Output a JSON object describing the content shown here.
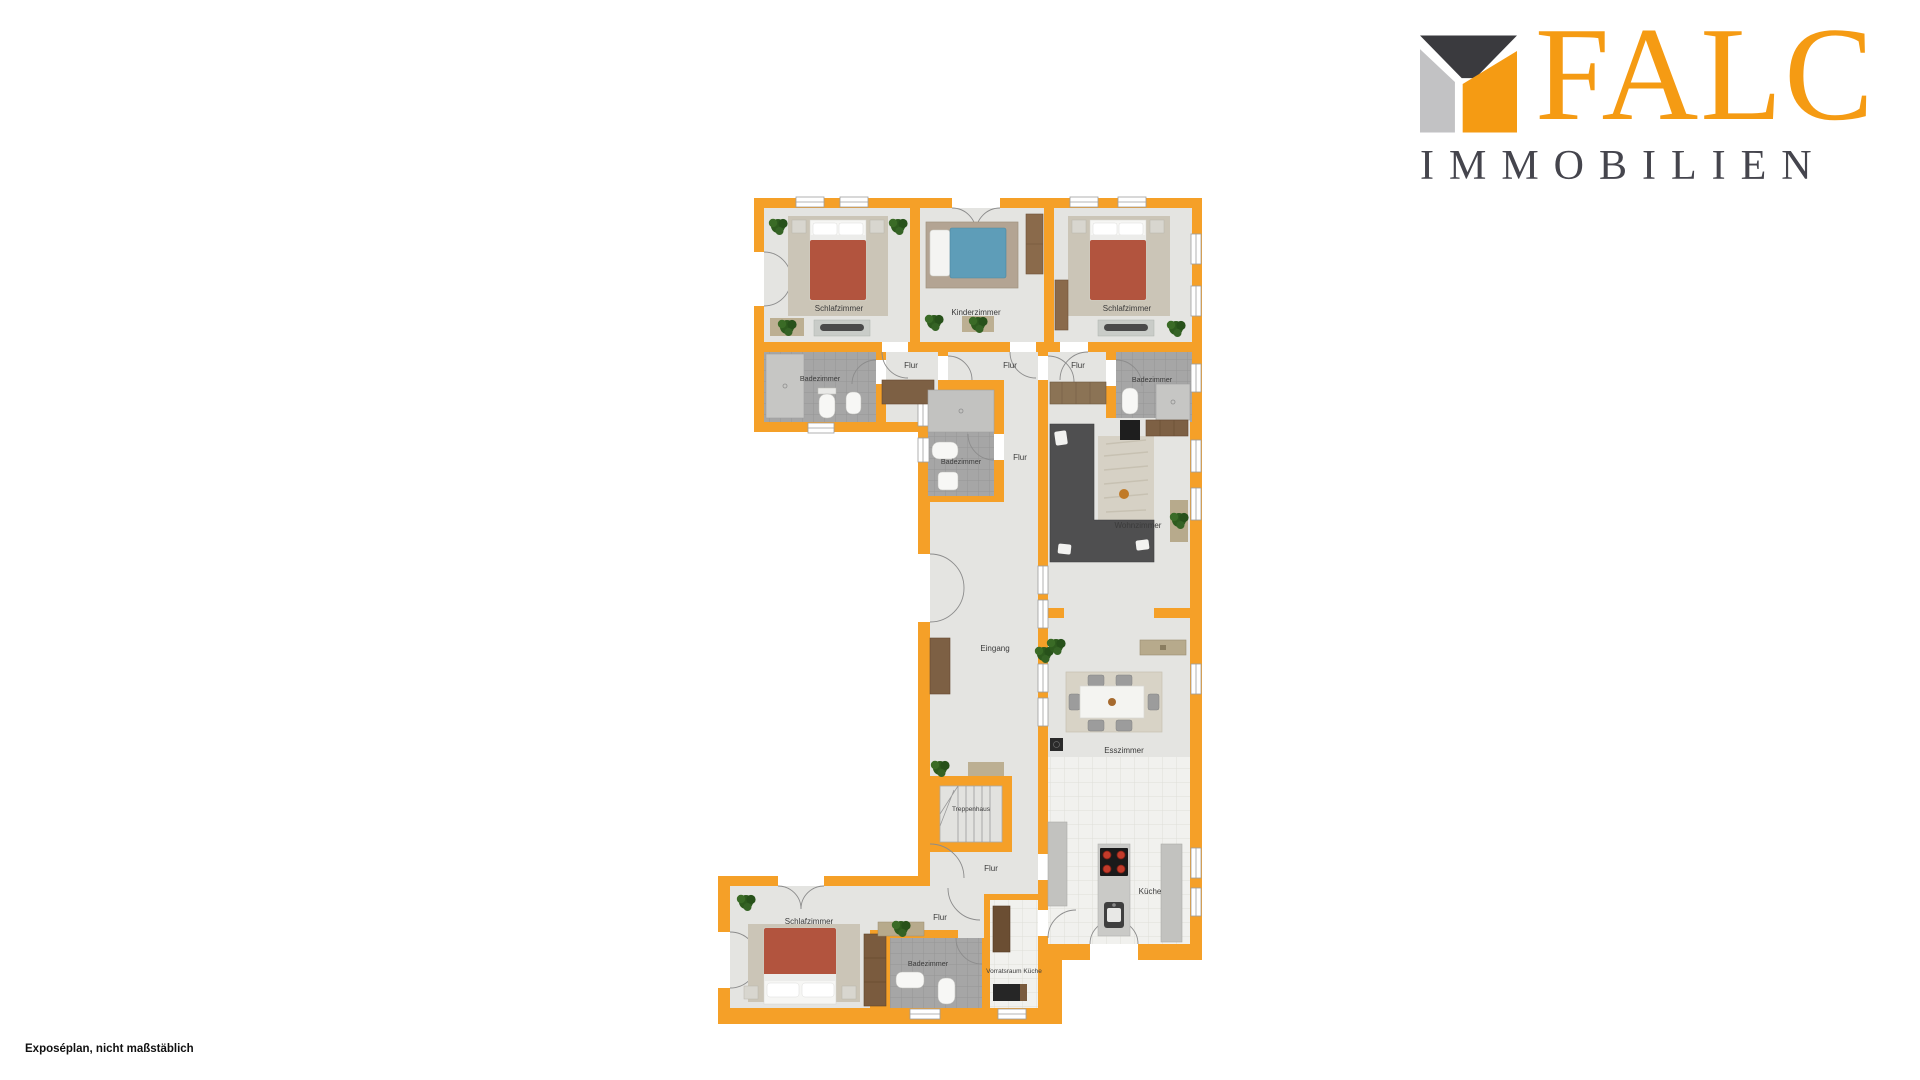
{
  "logo": {
    "brand": "FALC",
    "subtitle": "IMMOBILIEN"
  },
  "footer": {
    "note": "Exposéplan, nicht maßstäblich"
  },
  "palette": {
    "wall_orange": "#F5A028",
    "floor_gray": "#E4E4E1",
    "logo_orange": "#F59B13",
    "logo_dark": "#45454D",
    "logo_gray": "#C2C2C4",
    "bed_red": "#B2543E",
    "kids_bed_blue": "#5E9DB8"
  },
  "floorplan": {
    "rooms": [
      {
        "id": "bedroom-top-left",
        "label": "Schlafzimmer"
      },
      {
        "id": "kids-room",
        "label": "Kinderzimmer"
      },
      {
        "id": "bedroom-top-right",
        "label": "Schlafzimmer"
      },
      {
        "id": "bathroom-top-left",
        "label": "Badezimmer"
      },
      {
        "id": "hall-top-left",
        "label": "Flur"
      },
      {
        "id": "hall-top-center",
        "label": "Flur"
      },
      {
        "id": "hall-top-right",
        "label": "Flur"
      },
      {
        "id": "bathroom-top-right",
        "label": "Badezimmer"
      },
      {
        "id": "bathroom-middle",
        "label": "Badezimmer"
      },
      {
        "id": "hall-middle",
        "label": "Flur"
      },
      {
        "id": "living-room",
        "label": "Wohnzimmer"
      },
      {
        "id": "entrance",
        "label": "Eingang"
      },
      {
        "id": "dining-room",
        "label": "Esszimmer"
      },
      {
        "id": "staircase",
        "label": "Treppenhaus"
      },
      {
        "id": "hall-lower",
        "label": "Flur"
      },
      {
        "id": "kitchen",
        "label": "Küche"
      },
      {
        "id": "bedroom-bottom",
        "label": "Schlafzimmer"
      },
      {
        "id": "hall-bottom",
        "label": "Flur"
      },
      {
        "id": "bathroom-bottom",
        "label": "Badezimmer"
      },
      {
        "id": "pantry",
        "label": "Vorratsraum Küche"
      }
    ]
  }
}
